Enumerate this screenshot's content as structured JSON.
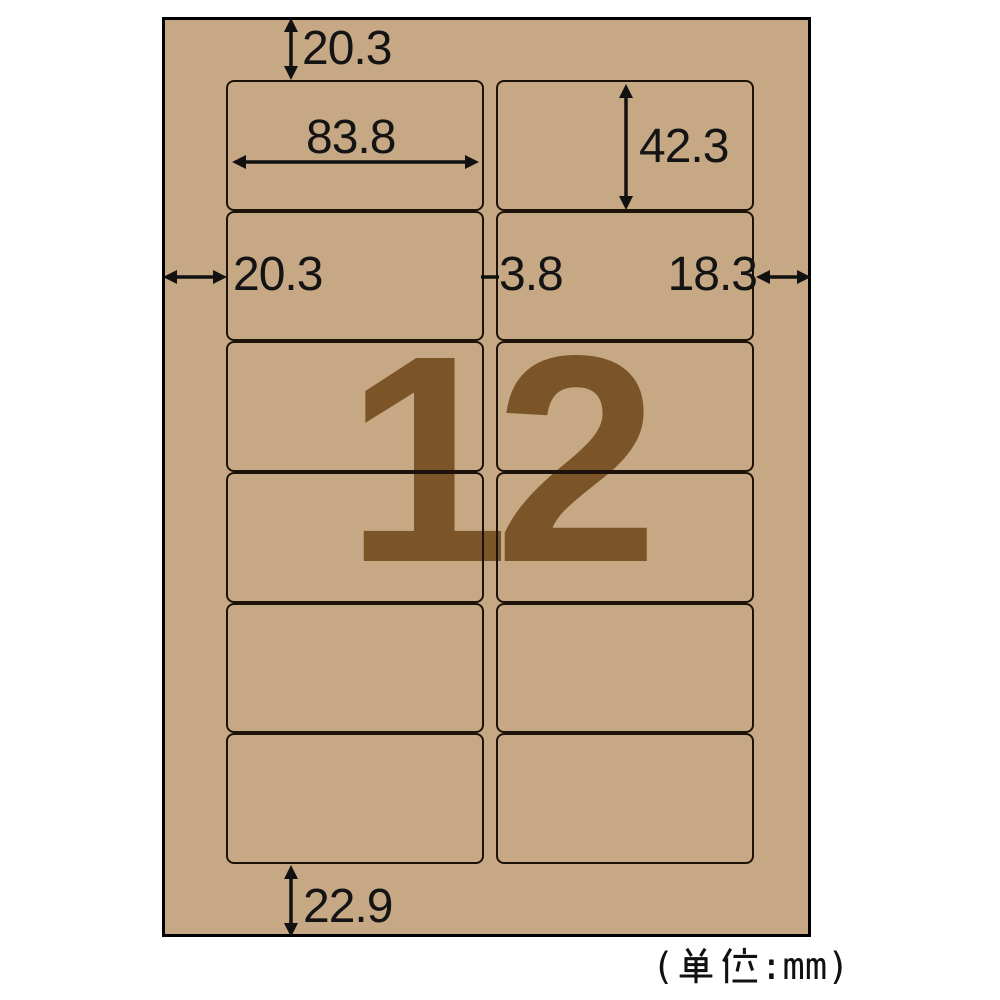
{
  "sheet": {
    "label_count": "12",
    "grid": {
      "rows": 6,
      "cols": 2
    },
    "colors": {
      "paper": "#c7a884",
      "watermark": "#7b5528",
      "line": "#1c120a"
    }
  },
  "dimensions": {
    "top_margin": "20.3",
    "label_width": "83.8",
    "label_height": "42.3",
    "left_margin": "20.3",
    "column_gap": "3.8",
    "right_margin": "18.3",
    "bottom_margin": "22.9"
  },
  "unit_note": {
    "full": "(単位:mm)",
    "prefix": "(",
    "kanji": "単位",
    "suffix": ":mm)"
  }
}
